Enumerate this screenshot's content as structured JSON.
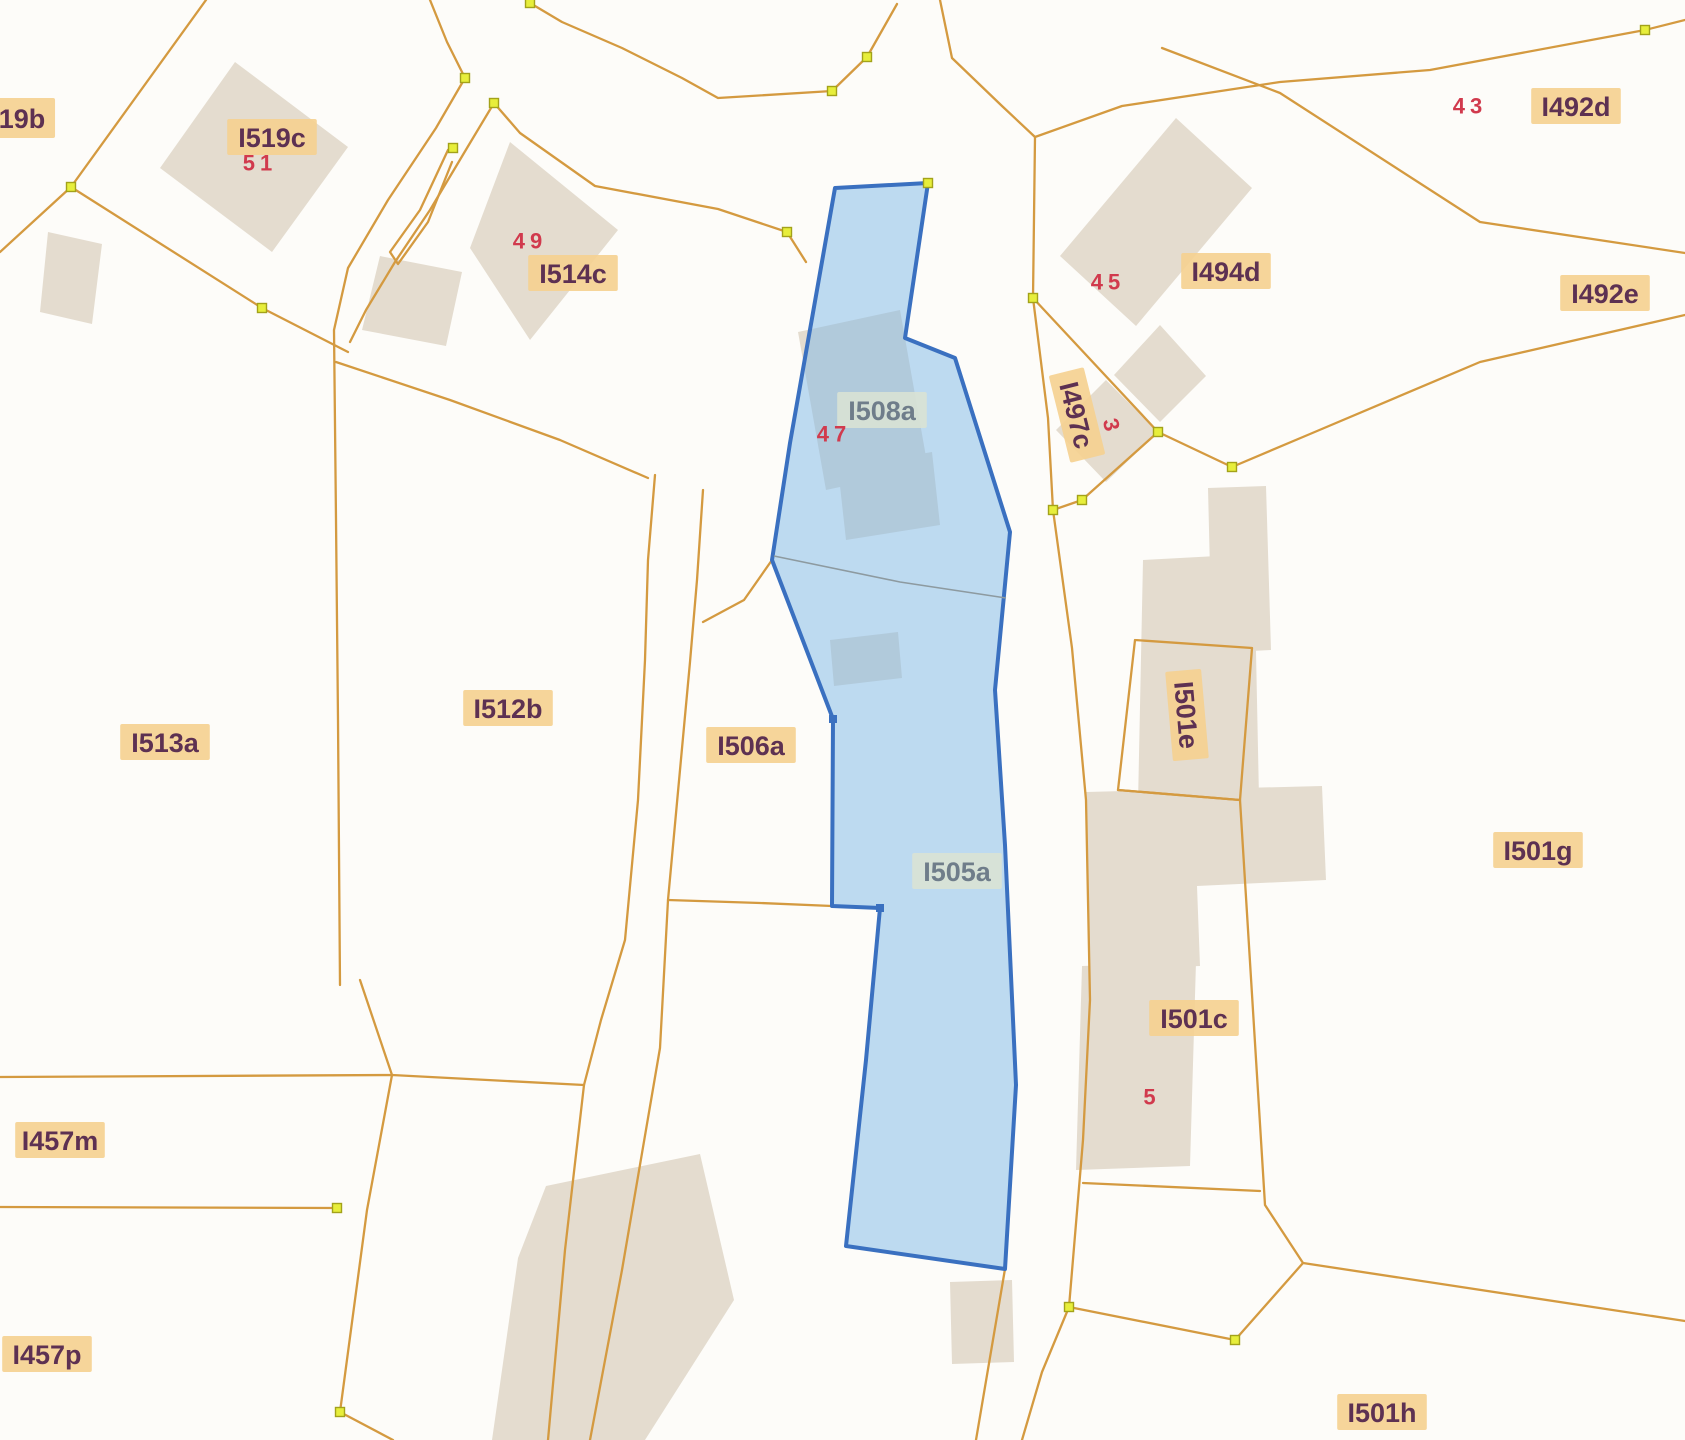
{
  "map": {
    "title": "cadastral-parcel-map",
    "width": 1685,
    "height": 1440,
    "colors": {
      "background": "#fdfcf9",
      "boundary": "#d49a40",
      "building_fill": "#e4dccf",
      "vertex_fill": "#e7ee3b",
      "vertex_stroke": "#a3a21a",
      "highlight_fill": "#7db8e8",
      "highlight_fill_opacity": 0.5,
      "highlight_stroke": "#3a70c0",
      "highlight_vertex": "#3a70c0",
      "inner_boundary": "#8d9aa0",
      "label_text": "#5d3152",
      "label_bg": "#f5d08f",
      "label_highlight_text": "#6f7d8a",
      "label_highlight_bg": "#d9e2d4",
      "number_text": "#d13a4d"
    },
    "highlight": {
      "selected_parcel_ids": [
        "I508a",
        "I505a"
      ],
      "outline": "835,188 928,183 905,338 955,358 1010,532 995,690 1005,845 1016,1085 1005,1269 846,1246 866,1060 880,908 832,906 833,719 772,560 790,443",
      "inner_boundary": "774,556 900,582 1006,598",
      "vertices": [
        [
          833,
          719
        ],
        [
          880,
          908
        ]
      ]
    },
    "parcel_labels": [
      {
        "id": "19b",
        "x": 22,
        "y": 118,
        "fs": 31
      },
      {
        "id": "I519c",
        "x": 272,
        "y": 137
      },
      {
        "id": "I514c",
        "x": 573,
        "y": 273
      },
      {
        "id": "I508a",
        "x": 882,
        "y": 410,
        "style": "highlight"
      },
      {
        "id": "I494d",
        "x": 1226,
        "y": 271
      },
      {
        "id": "I497c",
        "x": 1077,
        "y": 415,
        "rot": 76
      },
      {
        "id": "I492d",
        "x": 1576,
        "y": 106
      },
      {
        "id": "I492e",
        "x": 1605,
        "y": 293
      },
      {
        "id": "I513a",
        "x": 165,
        "y": 742
      },
      {
        "id": "I512b",
        "x": 508,
        "y": 708
      },
      {
        "id": "I506a",
        "x": 751,
        "y": 745
      },
      {
        "id": "I505a",
        "x": 957,
        "y": 871,
        "style": "highlight"
      },
      {
        "id": "I501e",
        "x": 1187,
        "y": 715,
        "rot": 85
      },
      {
        "id": "I501c",
        "x": 1194,
        "y": 1018
      },
      {
        "id": "I501g",
        "x": 1538,
        "y": 850
      },
      {
        "id": "I457m",
        "x": 60,
        "y": 1140
      },
      {
        "id": "I457p",
        "x": 47,
        "y": 1354
      },
      {
        "id": "I501h",
        "x": 1382,
        "y": 1412
      }
    ],
    "house_numbers": [
      {
        "text": "51",
        "x": 260,
        "y": 163
      },
      {
        "text": "49",
        "x": 530,
        "y": 241
      },
      {
        "text": "47",
        "x": 834,
        "y": 434
      },
      {
        "text": "45",
        "x": 1108,
        "y": 282
      },
      {
        "text": "3",
        "x": 1112,
        "y": 427,
        "rot": 76
      },
      {
        "text": "43",
        "x": 1470,
        "y": 106
      },
      {
        "text": "5",
        "x": 1152,
        "y": 1097
      }
    ],
    "boundaries": [
      {
        "points": "206,0 71,187 0,252"
      },
      {
        "points": "71,187 262,308 348,352"
      },
      {
        "points": "430,0 447,42 465,78"
      },
      {
        "points": "465,78 436,128 388,200 348,268 334,330 336,520 338,720 340,985"
      },
      {
        "points": "494,103 467,148 430,210 395,262 366,310 350,342"
      },
      {
        "points": "448,150 420,210 390,252 398,264 428,222 452,162"
      },
      {
        "points": "530,3 562,22 622,48 682,78 718,98 832,91 867,57 897,4"
      },
      {
        "points": "940,0 952,58 1002,106 1035,137"
      },
      {
        "points": "1035,137 1033,298 1048,418 1053,510 1072,648 1086,800 1090,1000 1083,1140 1069,1307"
      },
      {
        "points": "1069,1307 1042,1372 1022,1440"
      },
      {
        "points": "1069,1307 1235,1340 1303,1263 1685,1321"
      },
      {
        "points": "1645,30 1430,70 1280,82 1122,106 1035,137"
      },
      {
        "points": "1645,30 1685,20"
      },
      {
        "points": "1162,48 1280,93 1480,222 1685,253"
      },
      {
        "points": "1232,467 1310,434 1480,362 1685,315"
      },
      {
        "points": "1033,298 1158,432"
      },
      {
        "points": "1158,432 1082,500 1053,510"
      },
      {
        "points": "1158,432 1232,467"
      },
      {
        "points": "1135,640 1252,648 1240,800 1118,790 1135,640"
      },
      {
        "points": "1118,790 1240,800 1265,1205 1303,1263"
      },
      {
        "points": "1083,1183 1260,1191"
      },
      {
        "points": "0,1077 392,1075 584,1085"
      },
      {
        "points": "360,980 392,1075 367,1210 340,1412"
      },
      {
        "points": "340,1412 393,1440"
      },
      {
        "points": "0,1207 337,1208"
      },
      {
        "points": "655,475 648,560 645,660 638,800 625,940 601,1020 584,1085 565,1250 548,1440"
      },
      {
        "points": "703,490 697,580 690,662 680,770 668,900 660,1048 622,1270 590,1440"
      },
      {
        "points": "336,362 450,400 560,440 648,478"
      },
      {
        "points": "494,103 520,133 595,186 718,209 787,232 806,262"
      },
      {
        "points": "772,560 744,600 703,622"
      },
      {
        "points": "668,900 760,903 832,906"
      },
      {
        "points": "1016,1085 1005,1269 976,1440"
      }
    ],
    "buildings": [
      {
        "points": "235,62 348,147 272,252 160,168"
      },
      {
        "points": "48,232 102,244 92,324 40,312"
      },
      {
        "points": "510,142 618,230 530,340 470,248"
      },
      {
        "points": "380,256 462,272 446,346 362,330"
      },
      {
        "points": "1176,118 1252,188 1136,326 1060,256"
      },
      {
        "points": "1160,325 1206,376 1160,422 1114,375"
      },
      {
        "points": "1106,380 1158,432 1106,482 1056,430"
      },
      {
        "points": "1208,488 1266,486 1271,650 1212,653"
      },
      {
        "points": "1143,560 1254,554 1259,798 1138,804"
      },
      {
        "points": "1086,792 1322,786 1326,880 1197,886 1200,966 1090,970"
      },
      {
        "points": "1082,966 1196,962 1190,1166 1076,1170"
      },
      {
        "points": "950,1282 1012,1280 1014,1362 952,1364"
      },
      {
        "points": "546,1186 700,1154 734,1300 645,1440 492,1440 518,1258"
      },
      {
        "points": "798,332 900,310 928,468 826,490"
      },
      {
        "points": "838,468 932,452 940,525 846,540"
      },
      {
        "points": "830,640 898,632 902,678 834,686"
      }
    ],
    "vertices": [
      [
        530,
        3
      ],
      [
        832,
        91
      ],
      [
        867,
        57
      ],
      [
        465,
        78
      ],
      [
        494,
        103
      ],
      [
        453,
        148
      ],
      [
        71,
        187
      ],
      [
        262,
        308
      ],
      [
        787,
        232
      ],
      [
        928,
        183
      ],
      [
        1645,
        30
      ],
      [
        1033,
        298
      ],
      [
        1082,
        500
      ],
      [
        1053,
        510
      ],
      [
        1158,
        432
      ],
      [
        1232,
        467
      ],
      [
        337,
        1208
      ],
      [
        340,
        1412
      ],
      [
        1069,
        1307
      ],
      [
        1235,
        1340
      ]
    ]
  }
}
